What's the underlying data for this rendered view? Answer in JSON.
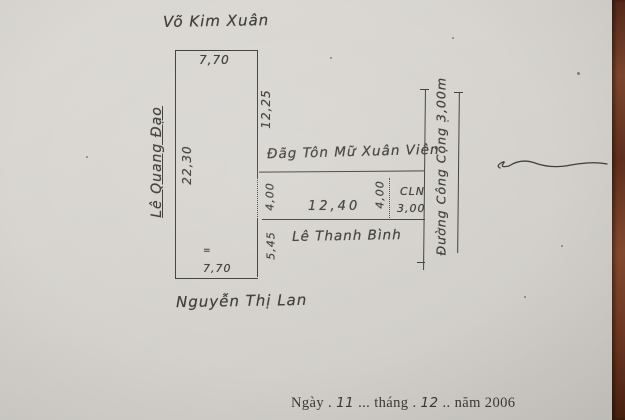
{
  "sketch": {
    "streets": {
      "top": "Võ Kim Xuân",
      "left": "Lê Quang Đạo",
      "bottom": "Nguyễn Thị Lan",
      "inner": "Lê Thanh Bình",
      "right_road": "Đường Công Cộng 3,00m",
      "neighbor": "Đãg Tôn Mữ Xuân Viên"
    },
    "dimensions": {
      "top_width": "7,70",
      "left_length": "22,30",
      "right_upper": "12,25",
      "right_gap": "4,00",
      "right_lower": "5,45",
      "bottom_width": "7,70",
      "strip_length": "12,40",
      "strip_right_gap": "4,00",
      "cln_label": "CLN",
      "cln_width": "3,00",
      "small_mark": "="
    },
    "date_line": {
      "prefix": "Ngày .",
      "day": "11",
      "middle": "... tháng .",
      "month": "12",
      "suffix": ".. năm 2006"
    }
  }
}
